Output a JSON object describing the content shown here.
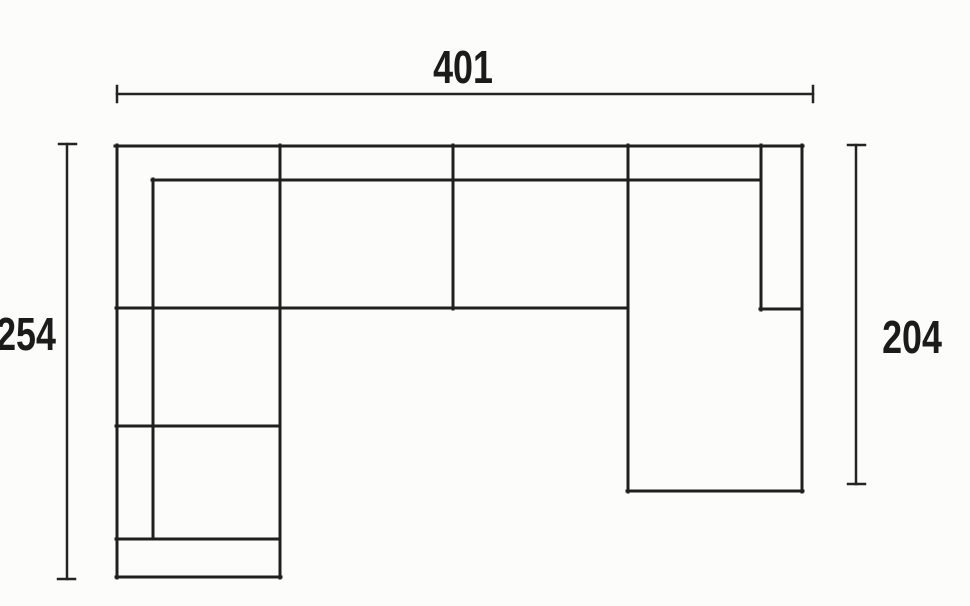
{
  "title": "Sectional sofa top-view technical drawing",
  "colors": {
    "background": "#fcfcfb",
    "sofa_line": "#1f1f1f",
    "dimension_line": "#242424",
    "text": "#1b1b1b"
  },
  "dimensions": {
    "top_width": "401",
    "left_depth": "254",
    "right_depth": "204"
  },
  "drawing": {
    "sofa_line_width": 3,
    "dimension_line_width": 2.5,
    "sofa_lines": [
      {
        "name": "outer-top-edge",
        "x1": 115,
        "y1": 146,
        "x2": 803,
        "y2": 146
      },
      {
        "name": "outer-left-edge",
        "x1": 117,
        "y1": 145,
        "x2": 117,
        "y2": 578
      },
      {
        "name": "left-chaise-bottom-edge",
        "x1": 116,
        "y1": 577,
        "x2": 281,
        "y2": 577
      },
      {
        "name": "left-chaise-right-edge",
        "x1": 280,
        "y1": 145,
        "x2": 280,
        "y2": 578
      },
      {
        "name": "outer-right-edge",
        "x1": 802,
        "y1": 145,
        "x2": 802,
        "y2": 492
      },
      {
        "name": "right-chaise-bottom-edge",
        "x1": 627,
        "y1": 491,
        "x2": 803,
        "y2": 491
      },
      {
        "name": "right-chaise-left-edge",
        "x1": 628,
        "y1": 145,
        "x2": 628,
        "y2": 492
      },
      {
        "name": "middle-seat-divider",
        "x1": 453,
        "y1": 145,
        "x2": 453,
        "y2": 309
      },
      {
        "name": "backrest-inner-line",
        "x1": 152,
        "y1": 180,
        "x2": 761,
        "y2": 180
      },
      {
        "name": "left-backrest-inner-line",
        "x1": 153,
        "y1": 179,
        "x2": 153,
        "y2": 539
      },
      {
        "name": "right-armrest-inner-line",
        "x1": 761,
        "y1": 145,
        "x2": 761,
        "y2": 310
      },
      {
        "name": "right-armrest-bottom-line",
        "x1": 760,
        "y1": 309,
        "x2": 802,
        "y2": 309
      },
      {
        "name": "seat-front-line",
        "x1": 116,
        "y1": 308,
        "x2": 628,
        "y2": 308
      },
      {
        "name": "left-chaise-seat-divider",
        "x1": 116,
        "y1": 426,
        "x2": 280,
        "y2": 426
      },
      {
        "name": "left-chaise-end-divider",
        "x1": 116,
        "y1": 539,
        "x2": 280,
        "y2": 539
      }
    ],
    "dimension_lines": [
      {
        "name": "top-dim-line",
        "x1": 117,
        "y1": 94,
        "x2": 813,
        "y2": 94
      },
      {
        "name": "top-dim-left-tick",
        "x1": 117,
        "y1": 86,
        "x2": 117,
        "y2": 102
      },
      {
        "name": "top-dim-right-tick",
        "x1": 813,
        "y1": 86,
        "x2": 813,
        "y2": 102
      },
      {
        "name": "left-dim-line",
        "x1": 67,
        "y1": 144,
        "x2": 67,
        "y2": 579
      },
      {
        "name": "left-dim-top-tick",
        "x1": 59,
        "y1": 144,
        "x2": 76,
        "y2": 144
      },
      {
        "name": "left-dim-bottom-tick",
        "x1": 58,
        "y1": 579,
        "x2": 75,
        "y2": 579
      },
      {
        "name": "right-dim-line",
        "x1": 856,
        "y1": 145,
        "x2": 856,
        "y2": 484
      },
      {
        "name": "right-dim-top-tick",
        "x1": 848,
        "y1": 145,
        "x2": 865,
        "y2": 145
      },
      {
        "name": "right-dim-bottom-tick",
        "x1": 848,
        "y1": 484,
        "x2": 865,
        "y2": 484
      }
    ]
  }
}
